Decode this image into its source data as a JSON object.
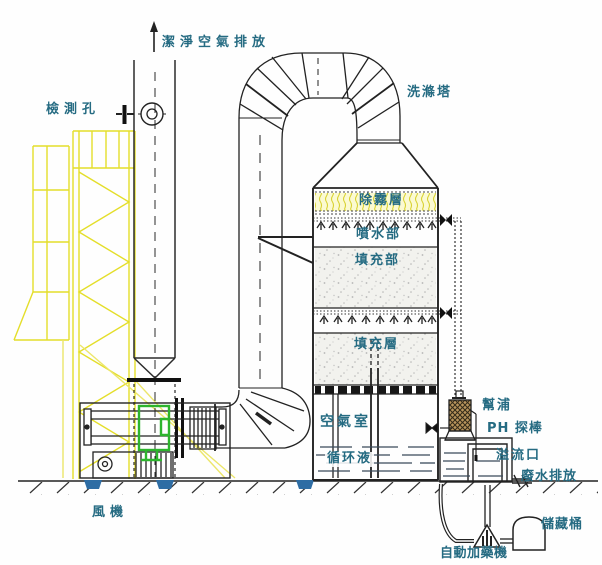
{
  "labels": {
    "clean_air_outlet": "潔淨空氣排放",
    "inspection_port": "檢測孔",
    "scrubber_tower": "洗滌塔",
    "demister_layer": "除霧層",
    "spray_section": "噴水部",
    "packing_section": "填充部",
    "packing_layer": "填充層",
    "air_chamber": "空氣室",
    "circulating_liquid": "循环液",
    "pump": "幫浦",
    "ph_probe": "PH 探棒",
    "overflow_port": "溢流口",
    "wastewater_discharge": "廢水排放",
    "storage_tank": "儲藏桶",
    "auto_dosing_machine": "自動加藥機",
    "fan": "風機"
  },
  "colors": {
    "label_teal": "#256b82",
    "frame_yellow": "#e4de2a",
    "flex_connector_green": "#2db52d",
    "mount_blue": "#2e6da4",
    "line_black": "#222222"
  }
}
